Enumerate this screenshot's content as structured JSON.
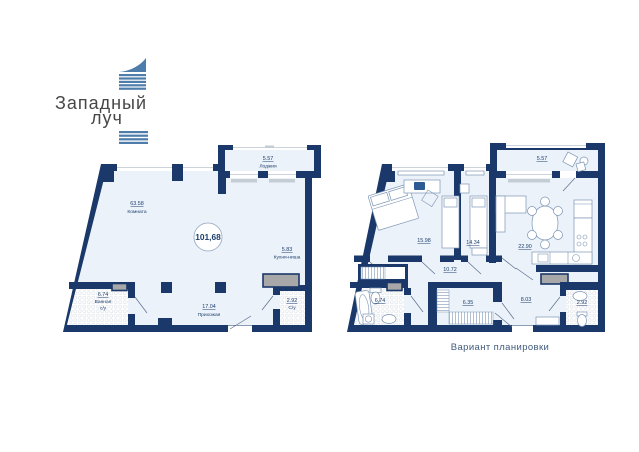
{
  "logo": {
    "line1": "Западный",
    "line2": "луч"
  },
  "caption": "Вариант планировки",
  "plan_original": {
    "total_area": "101,68",
    "loggia": {
      "area": "5.57",
      "name": "Лоджия"
    },
    "room": {
      "area": "63.58",
      "name": "Комната"
    },
    "kitchen": {
      "area": "5.83",
      "name": "Кухня-ниша"
    },
    "bath": {
      "area": "6.74",
      "name": "Ванная",
      "name2": "с/у"
    },
    "hall": {
      "area": "17.04",
      "name": "Прихожая"
    },
    "wc": {
      "area": "2.92",
      "name": "С/у"
    }
  },
  "plan_variant": {
    "loggia": "5.57",
    "bedroom1": "15.98",
    "bedroom2": "14.34",
    "living": "22.90",
    "hall": "10.72",
    "bath": "6.74",
    "wardrobe": "6.35",
    "entry": "8.03",
    "wc": "2.92"
  },
  "colors": {
    "wall": "#1a3869",
    "floor": "#ecf2f9",
    "label_text": "#1d3e6e",
    "vent": "#a8a8a8",
    "furniture_stroke": "#7d95b5",
    "logo_stripe": "#4e7dab",
    "logo_text": "#474747",
    "caption_text": "#3f5a7d"
  }
}
